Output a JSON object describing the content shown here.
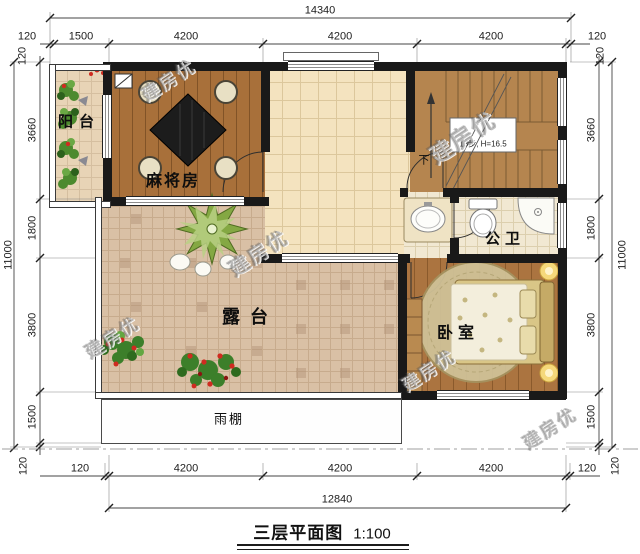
{
  "title": {
    "name": "三层平面图",
    "scale": "1:100"
  },
  "rooms": {
    "balcony": "阳台",
    "mahjong_room": "麻将房",
    "public_bath": "公卫",
    "terrace": "露台",
    "bedroom": "卧室",
    "rain_canopy": "雨棚"
  },
  "stairs": {
    "direction_label": "下",
    "note": "13步, H=16.5"
  },
  "watermark": "建房优",
  "dimensions": {
    "top": {
      "total": "14340",
      "segments": [
        "120",
        "1500",
        "4200",
        "4200",
        "4200",
        "120"
      ],
      "corner_offsets": [
        "120",
        "120"
      ]
    },
    "bottom": {
      "total": "12840",
      "segments": [
        "120",
        "4200",
        "4200",
        "4200",
        "120"
      ]
    },
    "left": {
      "total": "11000",
      "segments": [
        "3660",
        "1800",
        "3800",
        "1500",
        "120"
      ]
    },
    "right": {
      "total": "11000",
      "segments": [
        "3660",
        "1800",
        "3800",
        "1500",
        "120"
      ]
    }
  },
  "colors": {
    "wall": "#191919",
    "wood_floor": "#a8703a",
    "hall_tile": "#f4e3bf",
    "terrace_tile": "#d9c0a5",
    "bath_tile": "#f1e8d2",
    "stair_wood": "#b5854f",
    "plant_green": "#4c8a2e",
    "flower_red": "#cf2b20",
    "dimension_text": "#1d1d1d"
  }
}
